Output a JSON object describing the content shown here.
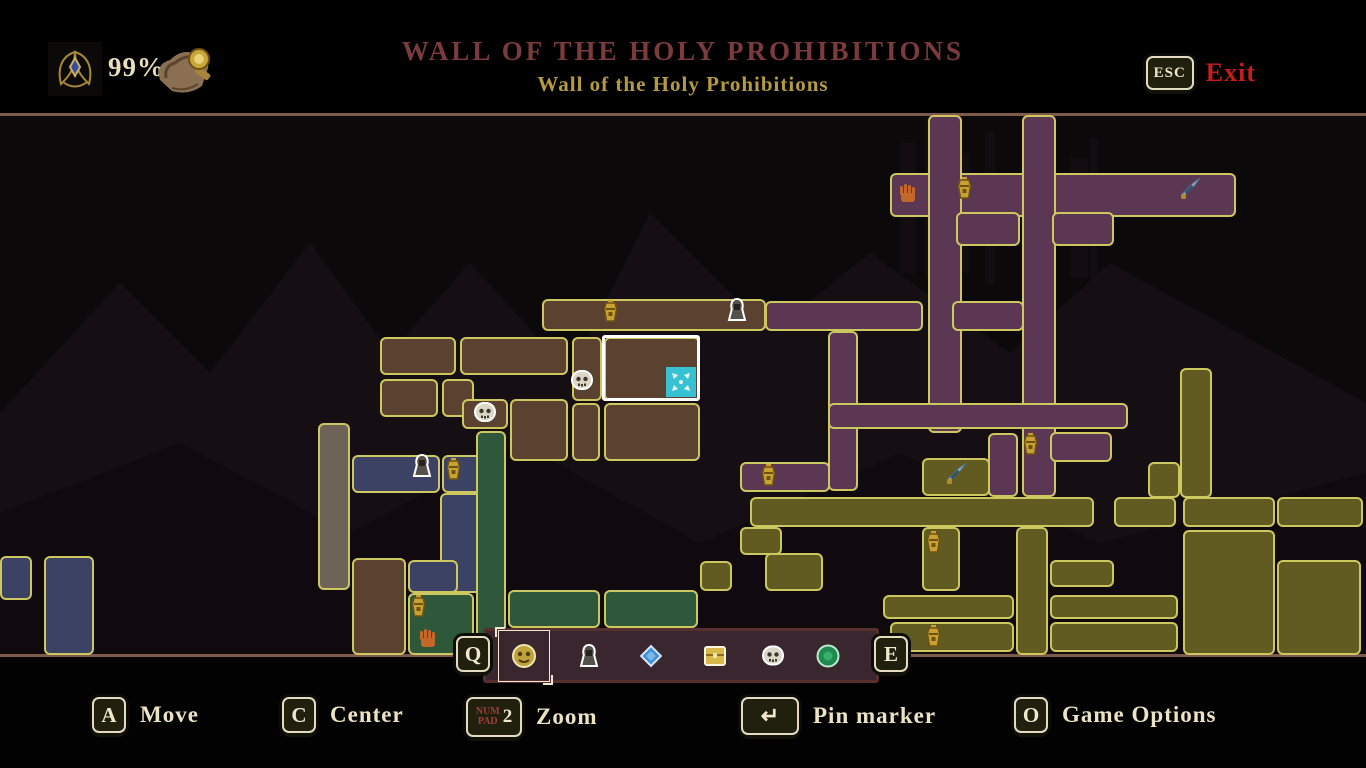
{
  "header": {
    "completion": "99%",
    "title": "WALL OF THE HOLY PROHIBITIONS",
    "subtitle": "Wall of the Holy Prohibitions",
    "exit_key": "ESC",
    "exit_label": "Exit",
    "completion_icon": "winged-relic-icon",
    "map_item_icon": "scroll-seal-icon"
  },
  "colors": {
    "brown": "#5a4130",
    "purple": "#5c3753",
    "olive": "#625b21",
    "green": "#2e5839",
    "blue": "#3b4263",
    "gray": "#6e6357",
    "border": "#cdc75f",
    "player": "#38c1d1",
    "boundary": "#7d5a49",
    "title_red": "#7b3b3c",
    "subtitle_gold": "#b59a40",
    "exit_red": "#c71c1c",
    "hint_cream": "#ece2c4",
    "panel": "#39262f"
  },
  "map": {
    "boundaries": [
      {
        "r": [
          0,
          0,
          1366,
          3
        ]
      },
      {
        "r": [
          0,
          541,
          1366,
          3
        ]
      }
    ],
    "rooms": [
      {
        "r": [
          542,
          186,
          224,
          32
        ],
        "c": "brown"
      },
      {
        "r": [
          380,
          224,
          76,
          38
        ],
        "c": "brown"
      },
      {
        "r": [
          460,
          224,
          108,
          38
        ],
        "c": "brown"
      },
      {
        "r": [
          572,
          224,
          30,
          64
        ],
        "c": "brown"
      },
      {
        "r": [
          604,
          224,
          96,
          64
        ],
        "c": "brown"
      },
      {
        "r": [
          380,
          266,
          58,
          38
        ],
        "c": "brown"
      },
      {
        "r": [
          442,
          266,
          32,
          38
        ],
        "c": "brown"
      },
      {
        "r": [
          462,
          286,
          46,
          30
        ],
        "c": "brown"
      },
      {
        "r": [
          510,
          286,
          58,
          62
        ],
        "c": "brown"
      },
      {
        "r": [
          572,
          290,
          28,
          58
        ],
        "c": "brown"
      },
      {
        "r": [
          604,
          290,
          96,
          58
        ],
        "c": "brown"
      },
      {
        "r": [
          352,
          445,
          54,
          97
        ],
        "c": "brown"
      },
      {
        "r": [
          410,
          512,
          38,
          30
        ],
        "c": "brown"
      },
      {
        "r": [
          318,
          310,
          32,
          167
        ],
        "c": "gray"
      },
      {
        "r": [
          352,
          342,
          88,
          38
        ],
        "c": "blue"
      },
      {
        "r": [
          442,
          342,
          40,
          38
        ],
        "c": "blue"
      },
      {
        "r": [
          440,
          380,
          42,
          100
        ],
        "c": "blue"
      },
      {
        "r": [
          408,
          447,
          50,
          33
        ],
        "c": "blue"
      },
      {
        "r": [
          0,
          443,
          32,
          44
        ],
        "c": "blue"
      },
      {
        "r": [
          44,
          443,
          50,
          99
        ],
        "c": "blue"
      },
      {
        "r": [
          476,
          318,
          30,
          224
        ],
        "c": "green"
      },
      {
        "r": [
          408,
          480,
          66,
          62
        ],
        "c": "green"
      },
      {
        "r": [
          508,
          477,
          92,
          38
        ],
        "c": "green"
      },
      {
        "r": [
          604,
          477,
          94,
          38
        ],
        "c": "green"
      },
      {
        "r": [
          508,
          515,
          92,
          27
        ],
        "c": "green"
      },
      {
        "r": [
          604,
          515,
          94,
          27
        ],
        "c": "green"
      },
      {
        "r": [
          890,
          60,
          44,
          44
        ],
        "c": "purple"
      },
      {
        "r": [
          936,
          60,
          300,
          44
        ],
        "c": "purple"
      },
      {
        "r": [
          928,
          2,
          34,
          318
        ],
        "c": "purple"
      },
      {
        "r": [
          1022,
          2,
          34,
          382
        ],
        "c": "purple"
      },
      {
        "r": [
          956,
          99,
          64,
          34
        ],
        "c": "purple"
      },
      {
        "r": [
          1052,
          99,
          62,
          34
        ],
        "c": "purple"
      },
      {
        "r": [
          952,
          188,
          72,
          30
        ],
        "c": "purple"
      },
      {
        "r": [
          765,
          188,
          158,
          30
        ],
        "c": "purple"
      },
      {
        "r": [
          828,
          218,
          30,
          160
        ],
        "c": "purple"
      },
      {
        "r": [
          828,
          290,
          300,
          26
        ],
        "c": "purple"
      },
      {
        "r": [
          740,
          349,
          90,
          30
        ],
        "c": "purple"
      },
      {
        "r": [
          1050,
          319,
          62,
          30
        ],
        "c": "purple"
      },
      {
        "r": [
          988,
          320,
          30,
          64
        ],
        "c": "purple"
      },
      {
        "r": [
          750,
          384,
          344,
          30
        ],
        "c": "olive"
      },
      {
        "r": [
          1114,
          384,
          62,
          30
        ],
        "c": "olive"
      },
      {
        "r": [
          922,
          345,
          68,
          38
        ],
        "c": "olive"
      },
      {
        "r": [
          922,
          414,
          38,
          64
        ],
        "c": "olive"
      },
      {
        "r": [
          1016,
          414,
          32,
          128
        ],
        "c": "olive"
      },
      {
        "r": [
          1050,
          447,
          64,
          27
        ],
        "c": "olive"
      },
      {
        "r": [
          883,
          482,
          131,
          24
        ],
        "c": "olive"
      },
      {
        "r": [
          890,
          509,
          124,
          30
        ],
        "c": "olive"
      },
      {
        "r": [
          1050,
          482,
          128,
          24
        ],
        "c": "olive"
      },
      {
        "r": [
          1050,
          509,
          128,
          30
        ],
        "c": "olive"
      },
      {
        "r": [
          1148,
          349,
          32,
          36
        ],
        "c": "olive"
      },
      {
        "r": [
          1180,
          255,
          32,
          130
        ],
        "c": "olive"
      },
      {
        "r": [
          1183,
          384,
          92,
          30
        ],
        "c": "olive"
      },
      {
        "r": [
          1277,
          384,
          86,
          30
        ],
        "c": "olive"
      },
      {
        "r": [
          1183,
          417,
          92,
          125
        ],
        "c": "olive"
      },
      {
        "r": [
          1277,
          447,
          84,
          95
        ],
        "c": "olive"
      },
      {
        "r": [
          765,
          440,
          58,
          38
        ],
        "c": "olive"
      },
      {
        "r": [
          700,
          448,
          32,
          30
        ],
        "c": "olive"
      },
      {
        "r": [
          740,
          414,
          42,
          28
        ],
        "c": "olive"
      }
    ],
    "current_room": {
      "r": [
        602,
        222,
        98,
        66
      ]
    },
    "player": {
      "r": [
        666,
        254,
        30,
        30
      ]
    },
    "markers": [
      {
        "t": "bell",
        "x": 602,
        "y": 186
      },
      {
        "t": "person",
        "x": 725,
        "y": 184
      },
      {
        "t": "skull",
        "x": 570,
        "y": 256
      },
      {
        "t": "skull",
        "x": 473,
        "y": 288
      },
      {
        "t": "hand",
        "x": 897,
        "y": 70
      },
      {
        "t": "bell",
        "x": 956,
        "y": 63
      },
      {
        "t": "sword",
        "x": 1178,
        "y": 62
      },
      {
        "t": "bell",
        "x": 1022,
        "y": 319
      },
      {
        "t": "bell",
        "x": 760,
        "y": 350
      },
      {
        "t": "sword",
        "x": 944,
        "y": 347
      },
      {
        "t": "bell",
        "x": 925,
        "y": 417
      },
      {
        "t": "bell",
        "x": 925,
        "y": 511
      },
      {
        "t": "person",
        "x": 410,
        "y": 340
      },
      {
        "t": "bell",
        "x": 445,
        "y": 344
      },
      {
        "t": "bell",
        "x": 410,
        "y": 481
      },
      {
        "t": "hand",
        "x": 417,
        "y": 515
      }
    ]
  },
  "toolbar": {
    "left_key": "Q",
    "right_key": "E",
    "items": [
      {
        "icon": "gold-mask",
        "x": 524,
        "selected": true
      },
      {
        "icon": "person",
        "x": 589,
        "selected": false
      },
      {
        "icon": "diamond",
        "x": 651,
        "selected": false
      },
      {
        "icon": "chest",
        "x": 715,
        "selected": false
      },
      {
        "icon": "skull",
        "x": 773,
        "selected": false
      },
      {
        "icon": "orb",
        "x": 828,
        "selected": false
      }
    ]
  },
  "hints": [
    {
      "id": "move",
      "x": 92,
      "key": "A",
      "style": "sq",
      "label": "Move"
    },
    {
      "id": "center",
      "x": 282,
      "key": "C",
      "style": "sq",
      "label": "Center"
    },
    {
      "id": "zoom",
      "x": 466,
      "key": "2",
      "key_small": "NUM PAD",
      "style": "numpad",
      "label": "Zoom"
    },
    {
      "id": "pin-marker",
      "x": 741,
      "key": "↵",
      "style": "wide",
      "label": "Pin marker"
    },
    {
      "id": "game-options",
      "x": 1014,
      "key": "O",
      "style": "sq",
      "label": "Game Options"
    }
  ]
}
